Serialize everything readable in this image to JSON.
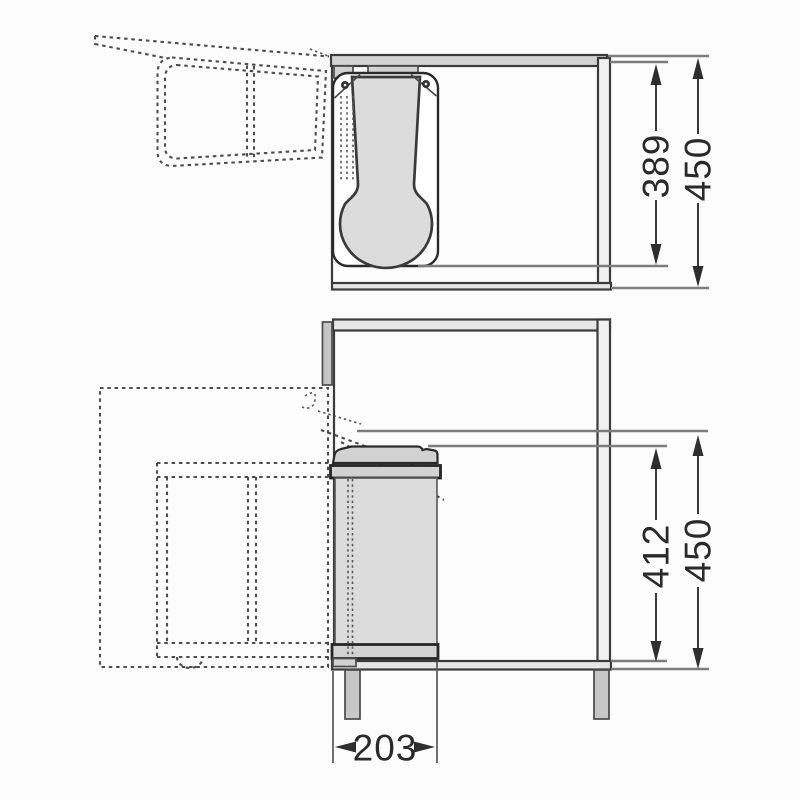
{
  "drawing": {
    "type": "cabinet-waste-bin-installation-diagram",
    "views": {
      "top_view": {
        "label": "top-view",
        "dims": {
          "bin_depth": "389",
          "cabinet_depth": "450"
        }
      },
      "front_view": {
        "label": "front-view",
        "dims": {
          "bin_height": "412",
          "cabinet_height": "450",
          "bin_width": "203"
        }
      }
    },
    "colors": {
      "background": "#fcfcfc",
      "line_dark": "#3b3b3b",
      "line_dimension": "#2e2e2e",
      "line_extension": "#7d7d7d",
      "line_dashed": "#4d4d4d",
      "fill_light_gray": "#dcdcdc",
      "fill_mid_gray": "#c6c6c6"
    }
  }
}
